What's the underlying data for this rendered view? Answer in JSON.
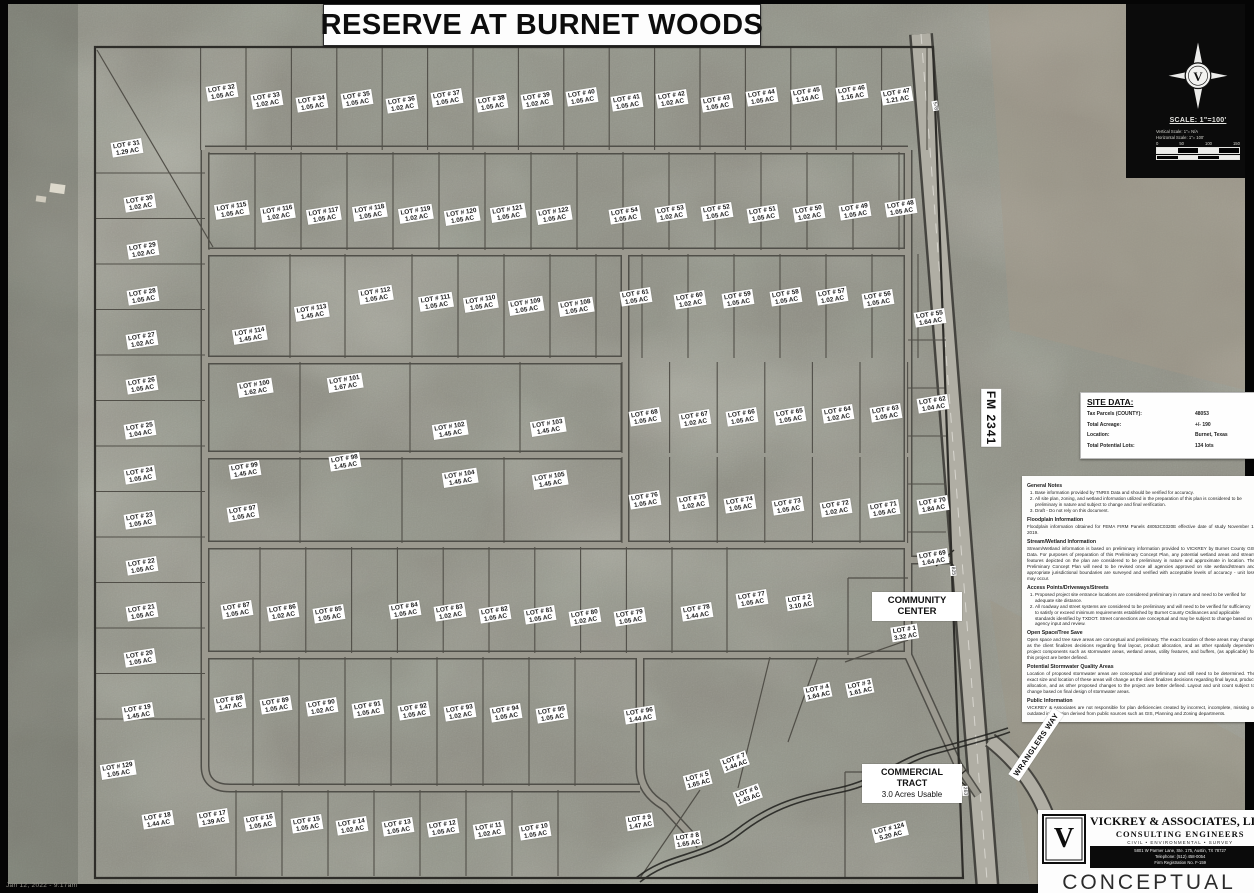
{
  "title": "RESERVE AT BURNET WOODS",
  "date_stamp": "Jan 12, 2022 - 9:17am",
  "compass": {
    "north_monogram": "V",
    "scale_label": "SCALE: 1\"=100'",
    "vertical_scale": "Vertical Scale:  1\"= N/A",
    "horizontal_scale": "Horizontal Scale:  1\"= 100'",
    "bar_ticks": [
      "0",
      "50",
      "100",
      "150"
    ]
  },
  "site_data": {
    "heading": "SITE DATA:",
    "rows": [
      {
        "label": "Tax Parcels (COUNTY):",
        "value": "48053"
      },
      {
        "label": "Total Acreage:",
        "value": "+/- 190"
      },
      {
        "label": "Location:",
        "value": "Burnet, Texas"
      },
      {
        "label": "Total Potential Lots:",
        "value": "134 lots"
      }
    ]
  },
  "notes": [
    {
      "heading": "General Notes",
      "items": [
        "Base information provided by TNRIS Data and should be verified for accuracy.",
        "All site plan, zoning, and wetland information utilized in the preparation of this plan is considered to be preliminary in nature and subject to change and final verification.",
        "Draft - Do not rely on this document."
      ]
    },
    {
      "heading": "Floodplain Information",
      "text": "Floodplain information obtained for FEMA FIRM Panels 48053C0320E effective date of study November 1, 2019."
    },
    {
      "heading": "Stream/Wetland Information",
      "text": "Stream/Wetland information is based on preliminary information provided to VICKREY by Burnet County GIS Data. For purposes of preparation of this Preliminary Concept Plan, any potential wetland areas and stream features depicted on the plan are considered to be preliminary in nature and approximate in location. The Preliminary Concept Plan will need to be revised once all agencies approved on site wetland/stream and appropriate jurisdictional boundaries are surveyed and verified with acceptable levels of accuracy - unit loss may occur."
    },
    {
      "heading": "Access Points/Driveways/Streets",
      "items": [
        "Proposed project site entrance locations are considered preliminary in nature and need to be verified for adequate site distance.",
        "All roadway and street systems are considered to be preliminary and will need to be verified for sufficiency to satisfy or exceed minimum requirements established by Burnet County Ordinances and applicable standards identified by TXDOT. Street connections are conceptual and may be subject to change based on agency input and review."
      ]
    },
    {
      "heading": "Open Space/Tree Save",
      "text": "Open space and tree save areas are conceptual and preliminary. The exact location of these areas may change as the client finalizes decisions regarding final layout, product allocation, and as other spatially dependent project components such as stormwater areas, wetland areas, utility features, and buffers, (as applicable) for this project are better defined."
    },
    {
      "heading": "Potential Stormwater Quality Areas",
      "text": "Location of proposed stormwater areas are conceptual and preliminary and still need to be determined. The exact size and location of these areas will change as the client finalizes decisions regarding final layout, product allocation, and as other proposed changes to the project are better defined. Layout and unit count subject to change based on final design of stormwater areas."
    },
    {
      "heading": "Public Information",
      "text": "VICKREY & Associates are not responsible for plan deficiencies created by incorrect, incomplete, missing or outdated information derived from public sources such as GIS, Planning and Zoning departments."
    }
  ],
  "map_labels": {
    "community_line1": "COMMUNITY",
    "community_line2": "CENTER",
    "commercial_line1": "COMMERCIAL",
    "commercial_line2": "TRACT",
    "commercial_line3": "3.0 Acres Usable",
    "fm_road": "FM 2341",
    "wranglers": "WRANGLERS WAY",
    "stations": [
      {
        "text": "578",
        "x": 930,
        "y": 103,
        "r": 80
      },
      {
        "text": "825",
        "x": 948,
        "y": 568,
        "r": 85
      },
      {
        "text": "263",
        "x": 960,
        "y": 788,
        "r": 85
      }
    ]
  },
  "company": {
    "monogram": "V",
    "name": "VICKREY & ASSOCIATES, LLC.",
    "subtitle": "CONSULTING ENGINEERS",
    "services": "CIVIL   •   ENVIRONMENTAL   •   SURVEY",
    "address_lines": [
      "5801 W Parmer Lane, Ste. 175, Austin, TX 78727",
      "Telephone: (512) 458-0054",
      "Firm Registration No. F-159"
    ],
    "stamp": "CONCEPTUAL",
    "stamp_disclaimer": "THIS DRAWING IS CONCEPTUAL ONLY AND FOR THE CONVENIENCE OF THE CLIENT. IT IS NOT INTENDED FOR CONSTRUCTION, RECORDING OR PERMIT PURPOSES AND IS SUBJECT TO CHANGE WITHOUT NOTICE."
  },
  "lot_label_prefix": "LOT #",
  "lot_unit": "AC",
  "colors": {
    "photo_base": "#8f8e84",
    "vegetation": "#565b4e",
    "road_surface": "#98968c",
    "parcel_line": "#514f48",
    "panel": "#ffffff",
    "ink": "#111111"
  },
  "lots": [
    [
      "31",
      "1.29",
      127,
      148
    ],
    [
      "30",
      "1.02",
      140,
      203
    ],
    [
      "29",
      "1.02",
      143,
      250
    ],
    [
      "28",
      "1.05",
      143,
      296
    ],
    [
      "27",
      "1.02",
      142,
      340
    ],
    [
      "26",
      "1.05",
      142,
      385
    ],
    [
      "25",
      "1.04",
      140,
      430
    ],
    [
      "24",
      "1.05",
      140,
      475
    ],
    [
      "23",
      "1.05",
      140,
      520
    ],
    [
      "22",
      "1.05",
      142,
      566
    ],
    [
      "21",
      "1.05",
      142,
      612
    ],
    [
      "20",
      "1.05",
      140,
      658
    ],
    [
      "19",
      "1.45",
      138,
      712
    ],
    [
      "129",
      "1.05",
      118,
      770
    ],
    [
      "32",
      "1.05",
      222,
      92
    ],
    [
      "33",
      "1.02",
      267,
      100
    ],
    [
      "34",
      "1.05",
      312,
      103
    ],
    [
      "35",
      "1.05",
      357,
      99
    ],
    [
      "36",
      "1.02",
      402,
      104
    ],
    [
      "37",
      "1.05",
      447,
      98
    ],
    [
      "38",
      "1.05",
      492,
      103
    ],
    [
      "39",
      "1.02",
      537,
      100
    ],
    [
      "40",
      "1.05",
      582,
      97
    ],
    [
      "41",
      "1.05",
      627,
      102
    ],
    [
      "42",
      "1.02",
      672,
      99
    ],
    [
      "43",
      "1.05",
      717,
      103
    ],
    [
      "44",
      "1.05",
      762,
      97
    ],
    [
      "45",
      "1.14",
      807,
      95
    ],
    [
      "46",
      "1.16",
      852,
      93
    ],
    [
      "47",
      "1.21",
      897,
      96
    ],
    [
      "115",
      "1.05",
      232,
      210
    ],
    [
      "116",
      "1.02",
      278,
      213
    ],
    [
      "117",
      "1.05",
      324,
      215
    ],
    [
      "118",
      "1.05",
      370,
      212
    ],
    [
      "119",
      "1.02",
      416,
      214
    ],
    [
      "120",
      "1.05",
      462,
      216
    ],
    [
      "121",
      "1.05",
      508,
      213
    ],
    [
      "122",
      "1.05",
      554,
      215
    ],
    [
      "54",
      "1.05",
      625,
      215
    ],
    [
      "53",
      "1.02",
      671,
      213
    ],
    [
      "52",
      "1.05",
      717,
      212
    ],
    [
      "51",
      "1.05",
      763,
      214
    ],
    [
      "50",
      "1.02",
      809,
      213
    ],
    [
      "49",
      "1.05",
      855,
      211
    ],
    [
      "48",
      "1.05",
      901,
      208
    ],
    [
      "114",
      "1.45",
      250,
      335
    ],
    [
      "113",
      "1.45",
      312,
      312
    ],
    [
      "112",
      "1.05",
      376,
      295
    ],
    [
      "111",
      "1.05",
      436,
      302
    ],
    [
      "110",
      "1.05",
      481,
      303
    ],
    [
      "109",
      "1.05",
      526,
      306
    ],
    [
      "108",
      "1.05",
      576,
      307
    ],
    [
      "61",
      "1.05",
      636,
      297
    ],
    [
      "60",
      "1.02",
      690,
      300
    ],
    [
      "59",
      "1.05",
      738,
      299
    ],
    [
      "58",
      "1.05",
      786,
      297
    ],
    [
      "57",
      "1.02",
      832,
      296
    ],
    [
      "56",
      "1.05",
      878,
      299
    ],
    [
      "55",
      "1.64",
      930,
      318
    ],
    [
      "100",
      "1.62",
      255,
      388
    ],
    [
      "101",
      "1.67",
      345,
      383
    ],
    [
      "102",
      "1.45",
      450,
      430
    ],
    [
      "103",
      "1.45",
      548,
      427
    ],
    [
      "68",
      "1.05",
      645,
      417
    ],
    [
      "67",
      "1.02",
      695,
      419
    ],
    [
      "66",
      "1.05",
      742,
      417
    ],
    [
      "65",
      "1.05",
      790,
      416
    ],
    [
      "64",
      "1.02",
      838,
      414
    ],
    [
      "63",
      "1.05",
      886,
      413
    ],
    [
      "62",
      "1.04",
      933,
      404
    ],
    [
      "99",
      "1.45",
      245,
      470
    ],
    [
      "98",
      "1.45",
      345,
      462
    ],
    [
      "104",
      "1.45",
      460,
      478
    ],
    [
      "105",
      "1.45",
      550,
      480
    ],
    [
      "97",
      "1.05",
      243,
      513
    ],
    [
      "76",
      "1.05",
      645,
      500
    ],
    [
      "75",
      "1.02",
      693,
      502
    ],
    [
      "74",
      "1.05",
      740,
      504
    ],
    [
      "73",
      "1.05",
      788,
      506
    ],
    [
      "72",
      "1.02",
      836,
      508
    ],
    [
      "71",
      "1.05",
      884,
      509
    ],
    [
      "70",
      "1.84",
      933,
      505
    ],
    [
      "69",
      "1.64",
      933,
      558
    ],
    [
      "87",
      "1.05",
      237,
      610
    ],
    [
      "86",
      "1.02",
      283,
      612
    ],
    [
      "85",
      "1.05",
      329,
      614
    ],
    [
      "84",
      "1.05",
      405,
      610
    ],
    [
      "83",
      "1.02",
      450,
      612
    ],
    [
      "82",
      "1.05",
      495,
      614
    ],
    [
      "81",
      "1.05",
      540,
      615
    ],
    [
      "80",
      "1.02",
      585,
      617
    ],
    [
      "79",
      "1.05",
      630,
      617
    ],
    [
      "78",
      "1.44",
      697,
      612
    ],
    [
      "77",
      "1.05",
      752,
      599
    ],
    [
      "2",
      "3.10",
      800,
      602
    ],
    [
      "88",
      "1.47",
      230,
      703
    ],
    [
      "89",
      "1.05",
      276,
      705
    ],
    [
      "90",
      "1.02",
      322,
      707
    ],
    [
      "91",
      "1.05",
      368,
      709
    ],
    [
      "92",
      "1.05",
      414,
      711
    ],
    [
      "93",
      "1.02",
      460,
      712
    ],
    [
      "94",
      "1.05",
      506,
      713
    ],
    [
      "95",
      "1.05",
      552,
      714
    ],
    [
      "96",
      "1.44",
      640,
      715
    ],
    [
      "7",
      "1.44",
      735,
      762,
      -20
    ],
    [
      "6",
      "1.43",
      748,
      795,
      -20
    ],
    [
      "5",
      "1.65",
      698,
      780,
      -15
    ],
    [
      "4",
      "1.64",
      818,
      692,
      -12
    ],
    [
      "3",
      "1.61",
      860,
      688,
      -12
    ],
    [
      "1",
      "3.32",
      905,
      633
    ],
    [
      "18",
      "1.44",
      158,
      820
    ],
    [
      "17",
      "1.39",
      213,
      818
    ],
    [
      "16",
      "1.05",
      260,
      822
    ],
    [
      "15",
      "1.05",
      307,
      824
    ],
    [
      "14",
      "1.02",
      352,
      826
    ],
    [
      "13",
      "1.05",
      398,
      827
    ],
    [
      "12",
      "1.05",
      443,
      828
    ],
    [
      "11",
      "1.02",
      489,
      830
    ],
    [
      "10",
      "1.05",
      535,
      831
    ],
    [
      "9",
      "1.47",
      640,
      822
    ],
    [
      "8",
      "1.65",
      688,
      840
    ],
    [
      "124",
      "5.20",
      890,
      832,
      -14
    ]
  ]
}
